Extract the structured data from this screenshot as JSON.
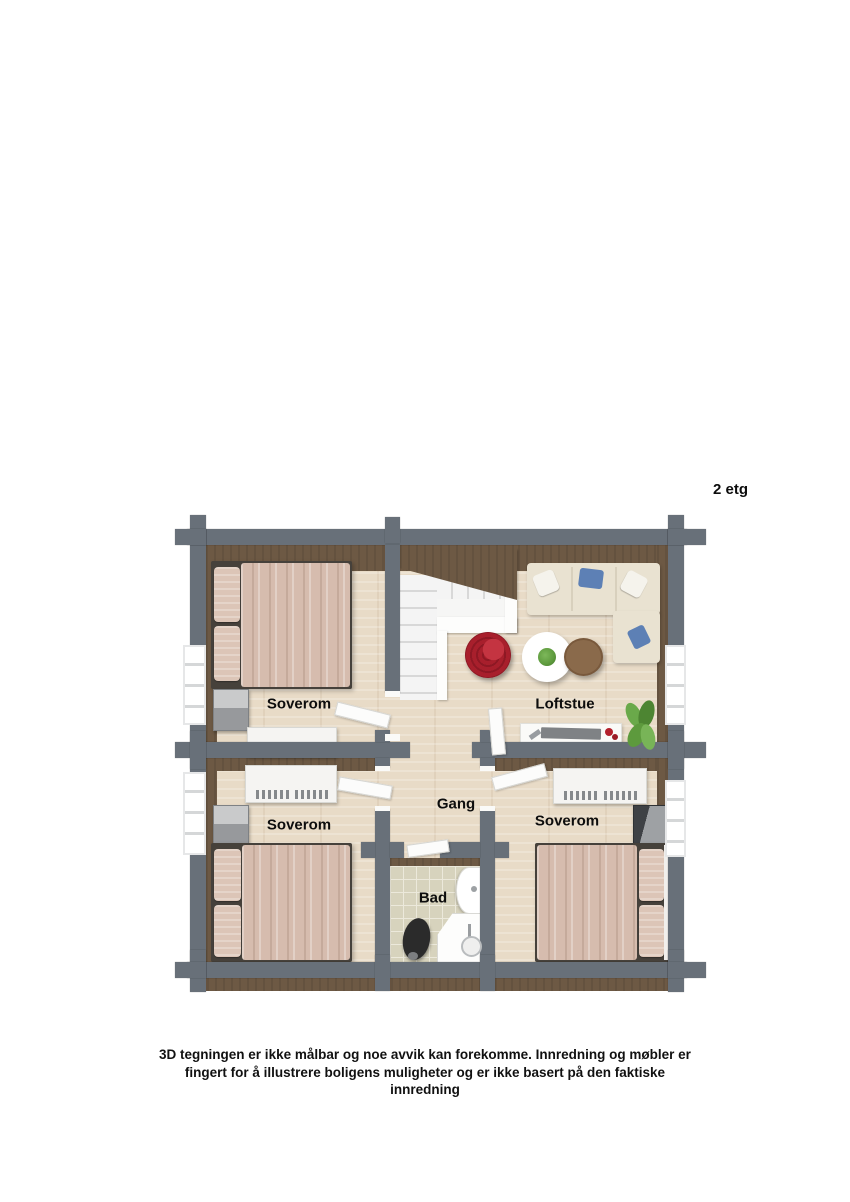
{
  "floor_label": "2 etg",
  "rooms": {
    "soverom_tl": {
      "label": "Soverom"
    },
    "loftstue": {
      "label": "Loftstue"
    },
    "gang": {
      "label": "Gang"
    },
    "soverom_bl": {
      "label": "Soverom"
    },
    "soverom_br": {
      "label": "Soverom"
    },
    "bad": {
      "label": "Bad"
    }
  },
  "disclaimer": "3D tegningen er ikke målbar og noe avvik kan forekomme. Innredning og møbler er fingert for å illustrere boligens muligheter og er ikke basert på den faktiske innredning",
  "colors": {
    "wall_gray": "#687079",
    "wood_brown": "#6d5944",
    "floor_wood": "#e8dbc7",
    "tile_beige": "#d7d3bd",
    "bed_linen": "#d6bcae",
    "bed_pillow": "#dcc5b7",
    "bed_frame": "#46413b",
    "sofa_cream": "#e9e2d1",
    "pillow_blue": "#5d80b5",
    "accent_red": "#a81f2c",
    "table_brown": "#8a6a4b",
    "plant_green": "#5d9a3d"
  }
}
